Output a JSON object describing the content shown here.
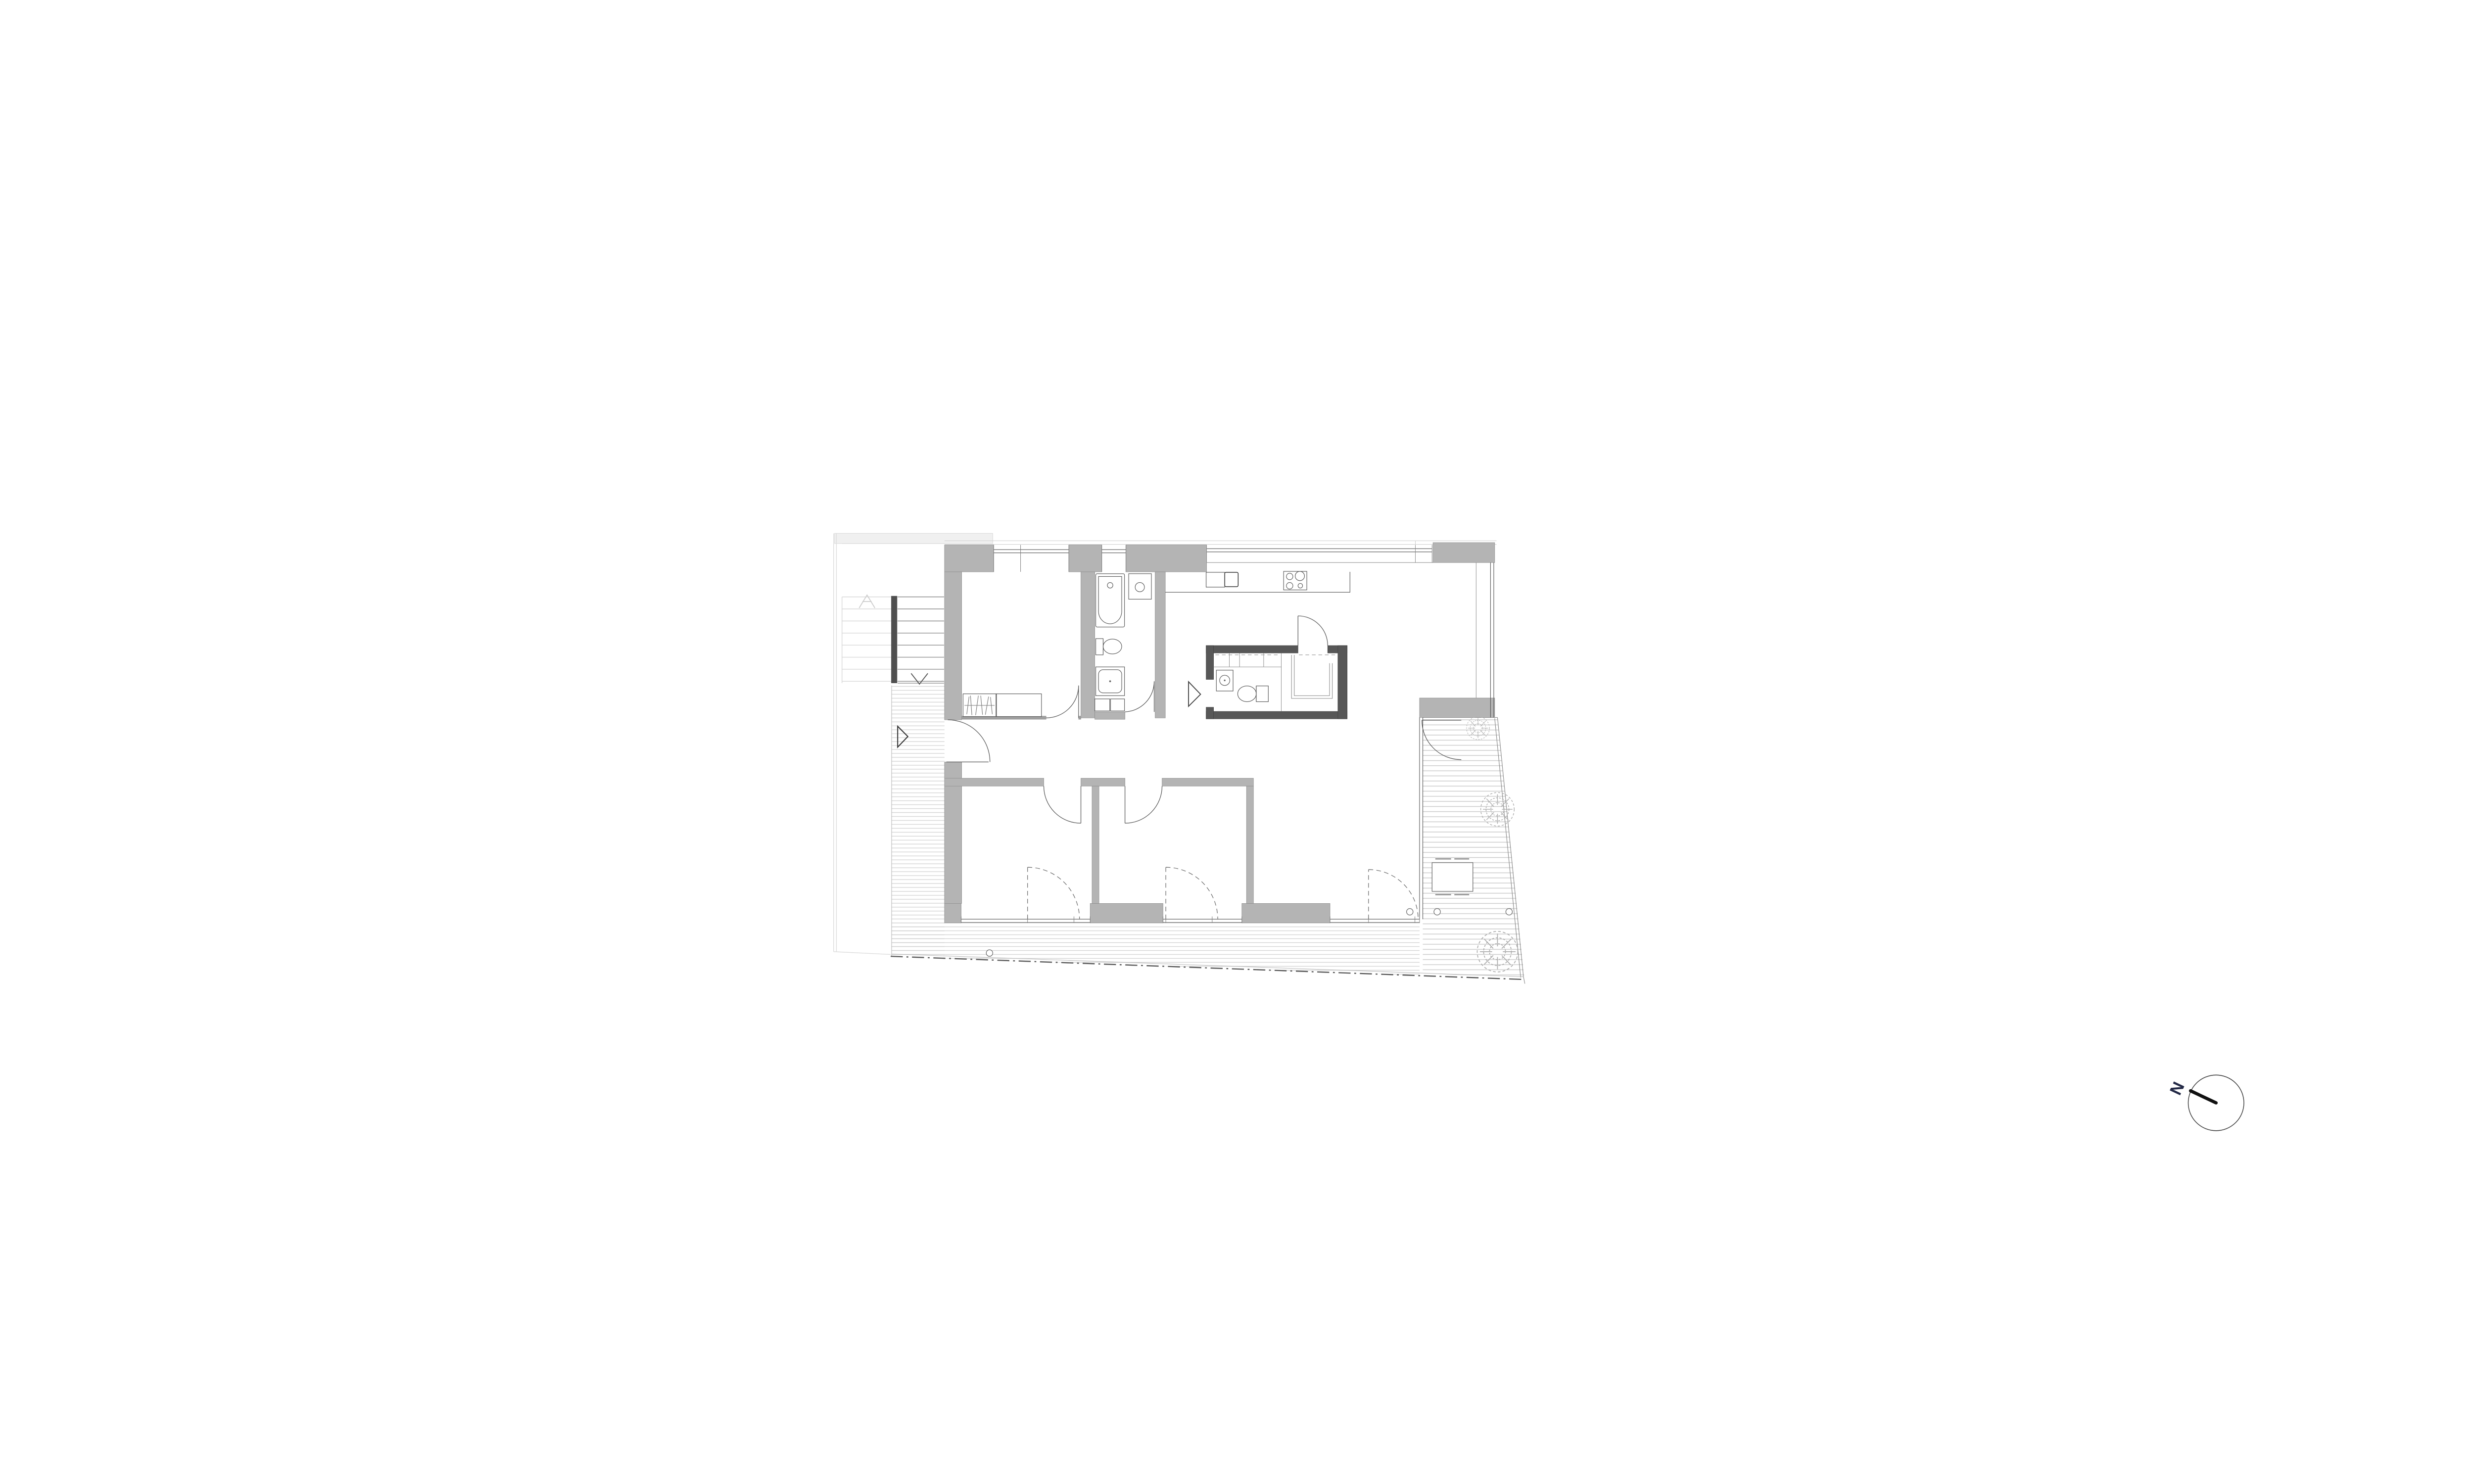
{
  "compass": {
    "label": "N"
  },
  "drawing": {
    "kind": "residential apartment floor plan",
    "sheet_background": "#ffffff",
    "rooms": [
      "bedroom-northwest",
      "bathroom",
      "hallway",
      "bedroom-south-1",
      "bedroom-south-2",
      "kitchen-living-room",
      "wet-core-wc",
      "walk-in-storage"
    ],
    "outdoor_areas": [
      "entry-deck-strip",
      "south-deck",
      "east-terrace"
    ],
    "stairs": {
      "flights": 1,
      "treads": 8,
      "direction_marker": "V",
      "handrail": "dark bar"
    },
    "fixtures": {
      "bathroom": [
        "bathtub",
        "washbasin-cabinet",
        "toilet",
        "shower",
        "hall-cabinets"
      ],
      "wet_core": [
        "round-sink",
        "toilet",
        "closet-shelves",
        "u-shaped-bench"
      ],
      "kitchen": [
        "wall-counter",
        "double-sink",
        "cooktop-4-burners"
      ],
      "bedroom_northwest": [
        "wardrobe-with-hangers",
        "cabinet"
      ],
      "terrace": [
        "outdoor-table",
        "bench-dashes"
      ]
    },
    "counts": {
      "shrubs": 3,
      "deck-markers": 4,
      "hinged-doors": 7,
      "dashed-terrace-doors": 3,
      "top-windows": 3
    },
    "colors": {
      "wall_fill": "#b4b4b4",
      "wet_core_wall": "#575757",
      "outline": "#555555",
      "deck_lines": "#cbcbcb",
      "boundary_line": "#555555",
      "faint_neighbor": "#dddddd",
      "compass_label": "#232946"
    }
  }
}
